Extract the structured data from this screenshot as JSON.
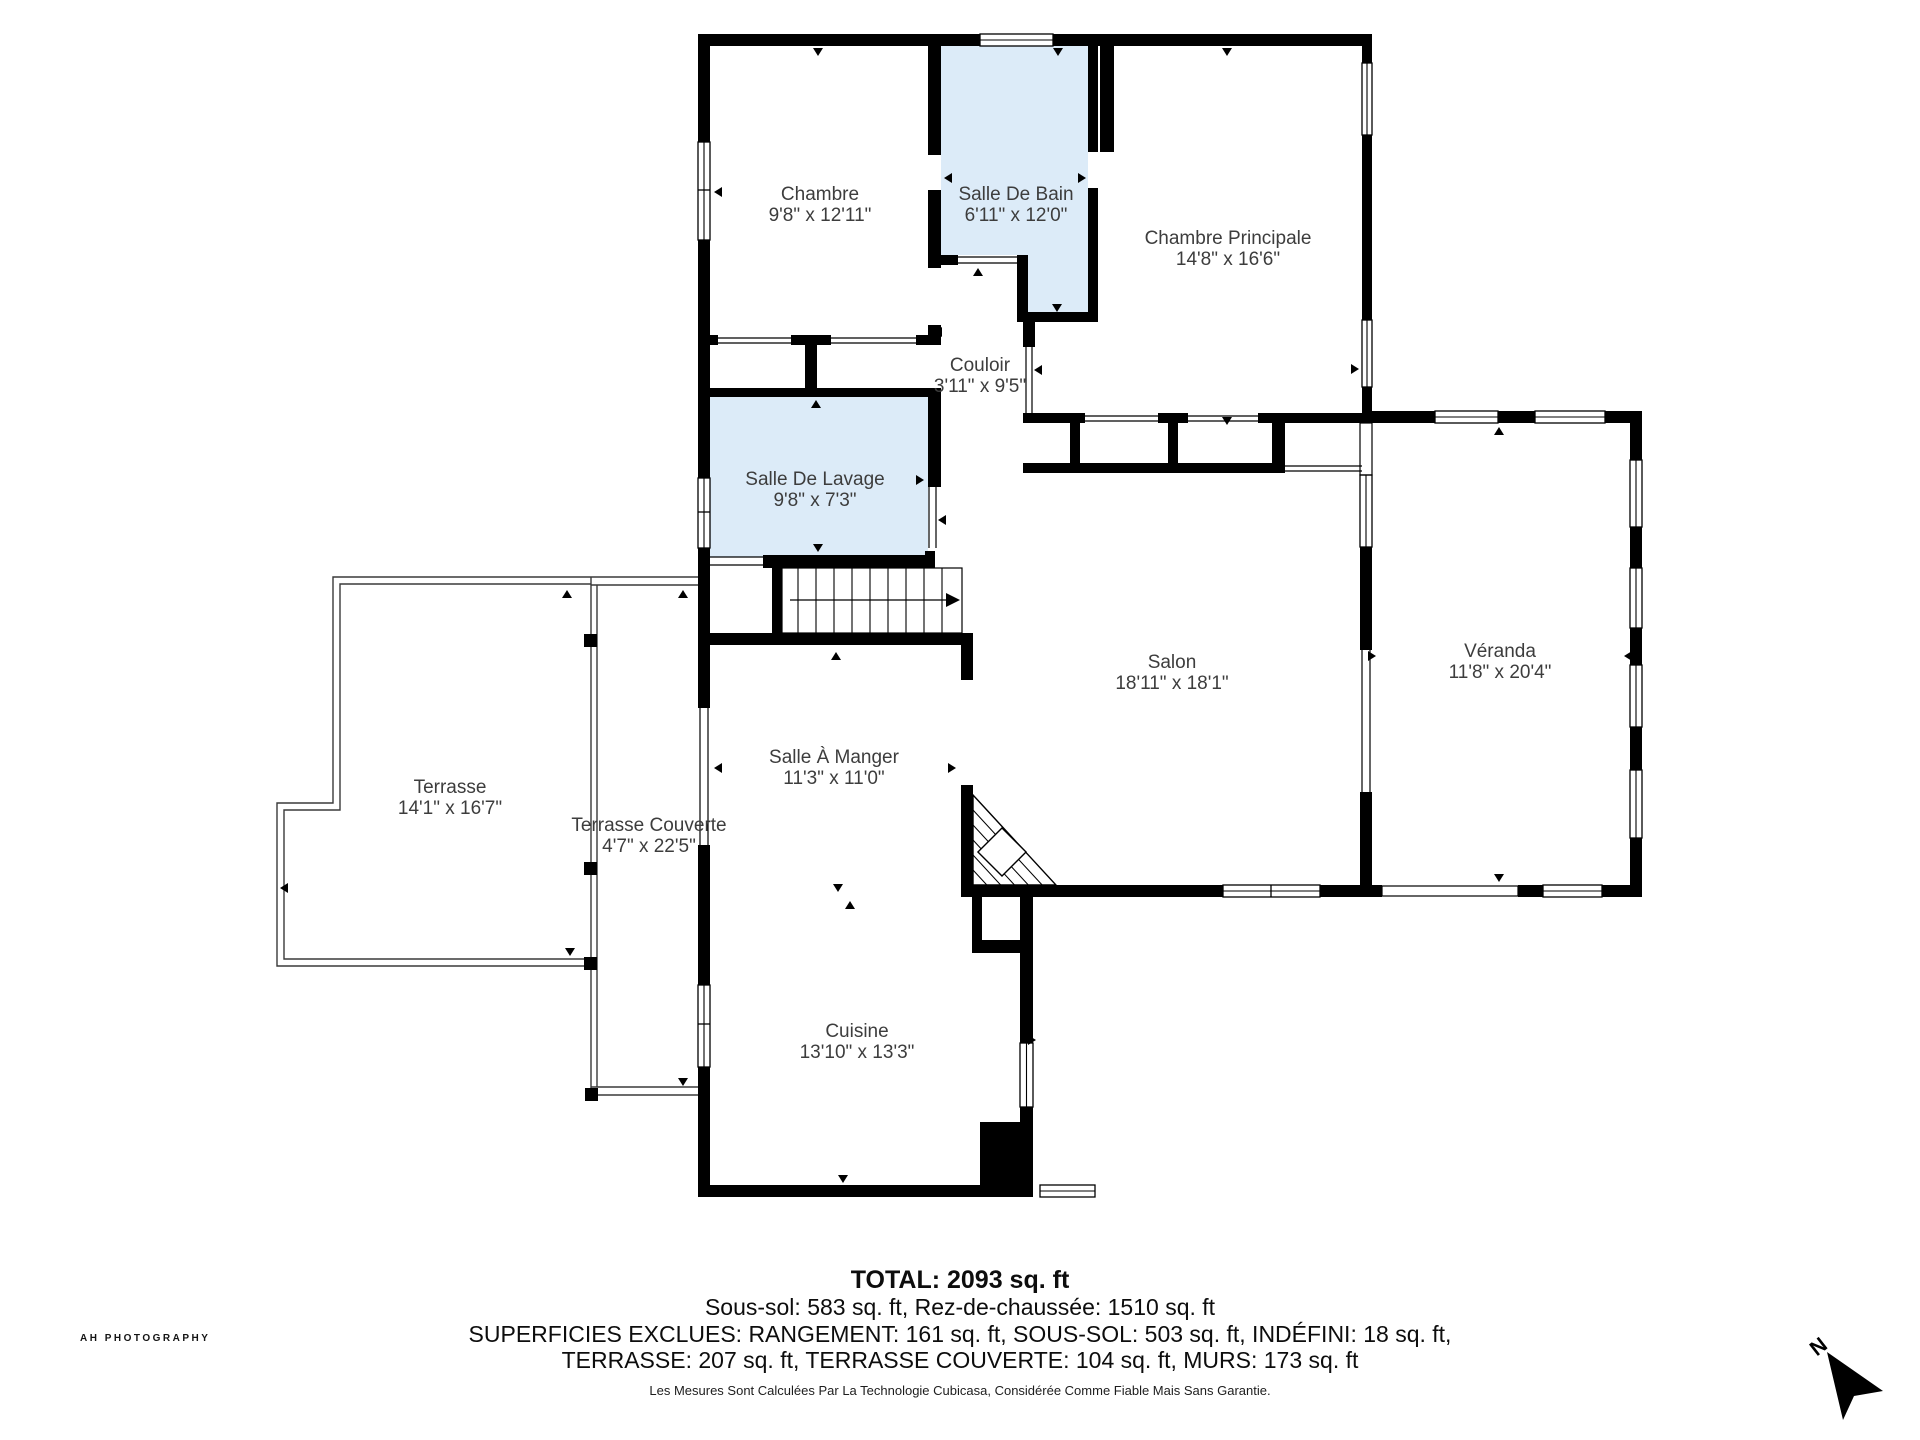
{
  "plan": {
    "rooms": {
      "chambre": {
        "name": "Chambre",
        "dims": "9'8\" x 12'11\""
      },
      "salle_de_bain": {
        "name": "Salle De Bain",
        "dims": "6'11\" x 12'0\""
      },
      "chambre_principale": {
        "name": "Chambre Principale",
        "dims": "14'8\" x 16'6\""
      },
      "couloir": {
        "name": "Couloir",
        "dims": "3'11\" x 9'5\""
      },
      "salle_de_lavage": {
        "name": "Salle De Lavage",
        "dims": "9'8\" x 7'3\""
      },
      "salon": {
        "name": "Salon",
        "dims": "18'11\" x 18'1\""
      },
      "veranda": {
        "name": "Véranda",
        "dims": "11'8\" x 20'4\""
      },
      "salle_a_manger": {
        "name": "Salle À Manger",
        "dims": "11'3\" x 11'0\""
      },
      "terrasse": {
        "name": "Terrasse",
        "dims": "14'1\" x 16'7\""
      },
      "terrasse_couverte": {
        "name": "Terrasse Couverte",
        "dims": "4'7\" x 22'5\""
      },
      "cuisine": {
        "name": "Cuisine",
        "dims": "13'10\" x 13'3\""
      }
    }
  },
  "footer": {
    "total": "TOTAL: 2093 sq. ft",
    "line2": "Sous-sol: 583 sq. ft, Rez-de-chaussée: 1510 sq. ft",
    "line3": "SUPERFICIES EXCLUES: RANGEMENT: 161 sq. ft, SOUS-SOL: 503 sq. ft, INDÉFINI: 18 sq. ft,",
    "line4": "TERRASSE: 207 sq. ft, TERRASSE COUVERTE: 104 sq. ft, MURS: 173 sq. ft",
    "disclaimer": "Les Mesures Sont Calculées Par La Technologie Cubicasa, Considérée Comme Fiable Mais Sans Garantie."
  },
  "branding": {
    "watermark": "AH PHOTOGRAPHY"
  },
  "compass": {
    "label": "N"
  },
  "colors": {
    "wall": "#000000",
    "wet_room_fill": "#dcebf8",
    "label_text": "#3d3d3d",
    "background": "#ffffff"
  }
}
